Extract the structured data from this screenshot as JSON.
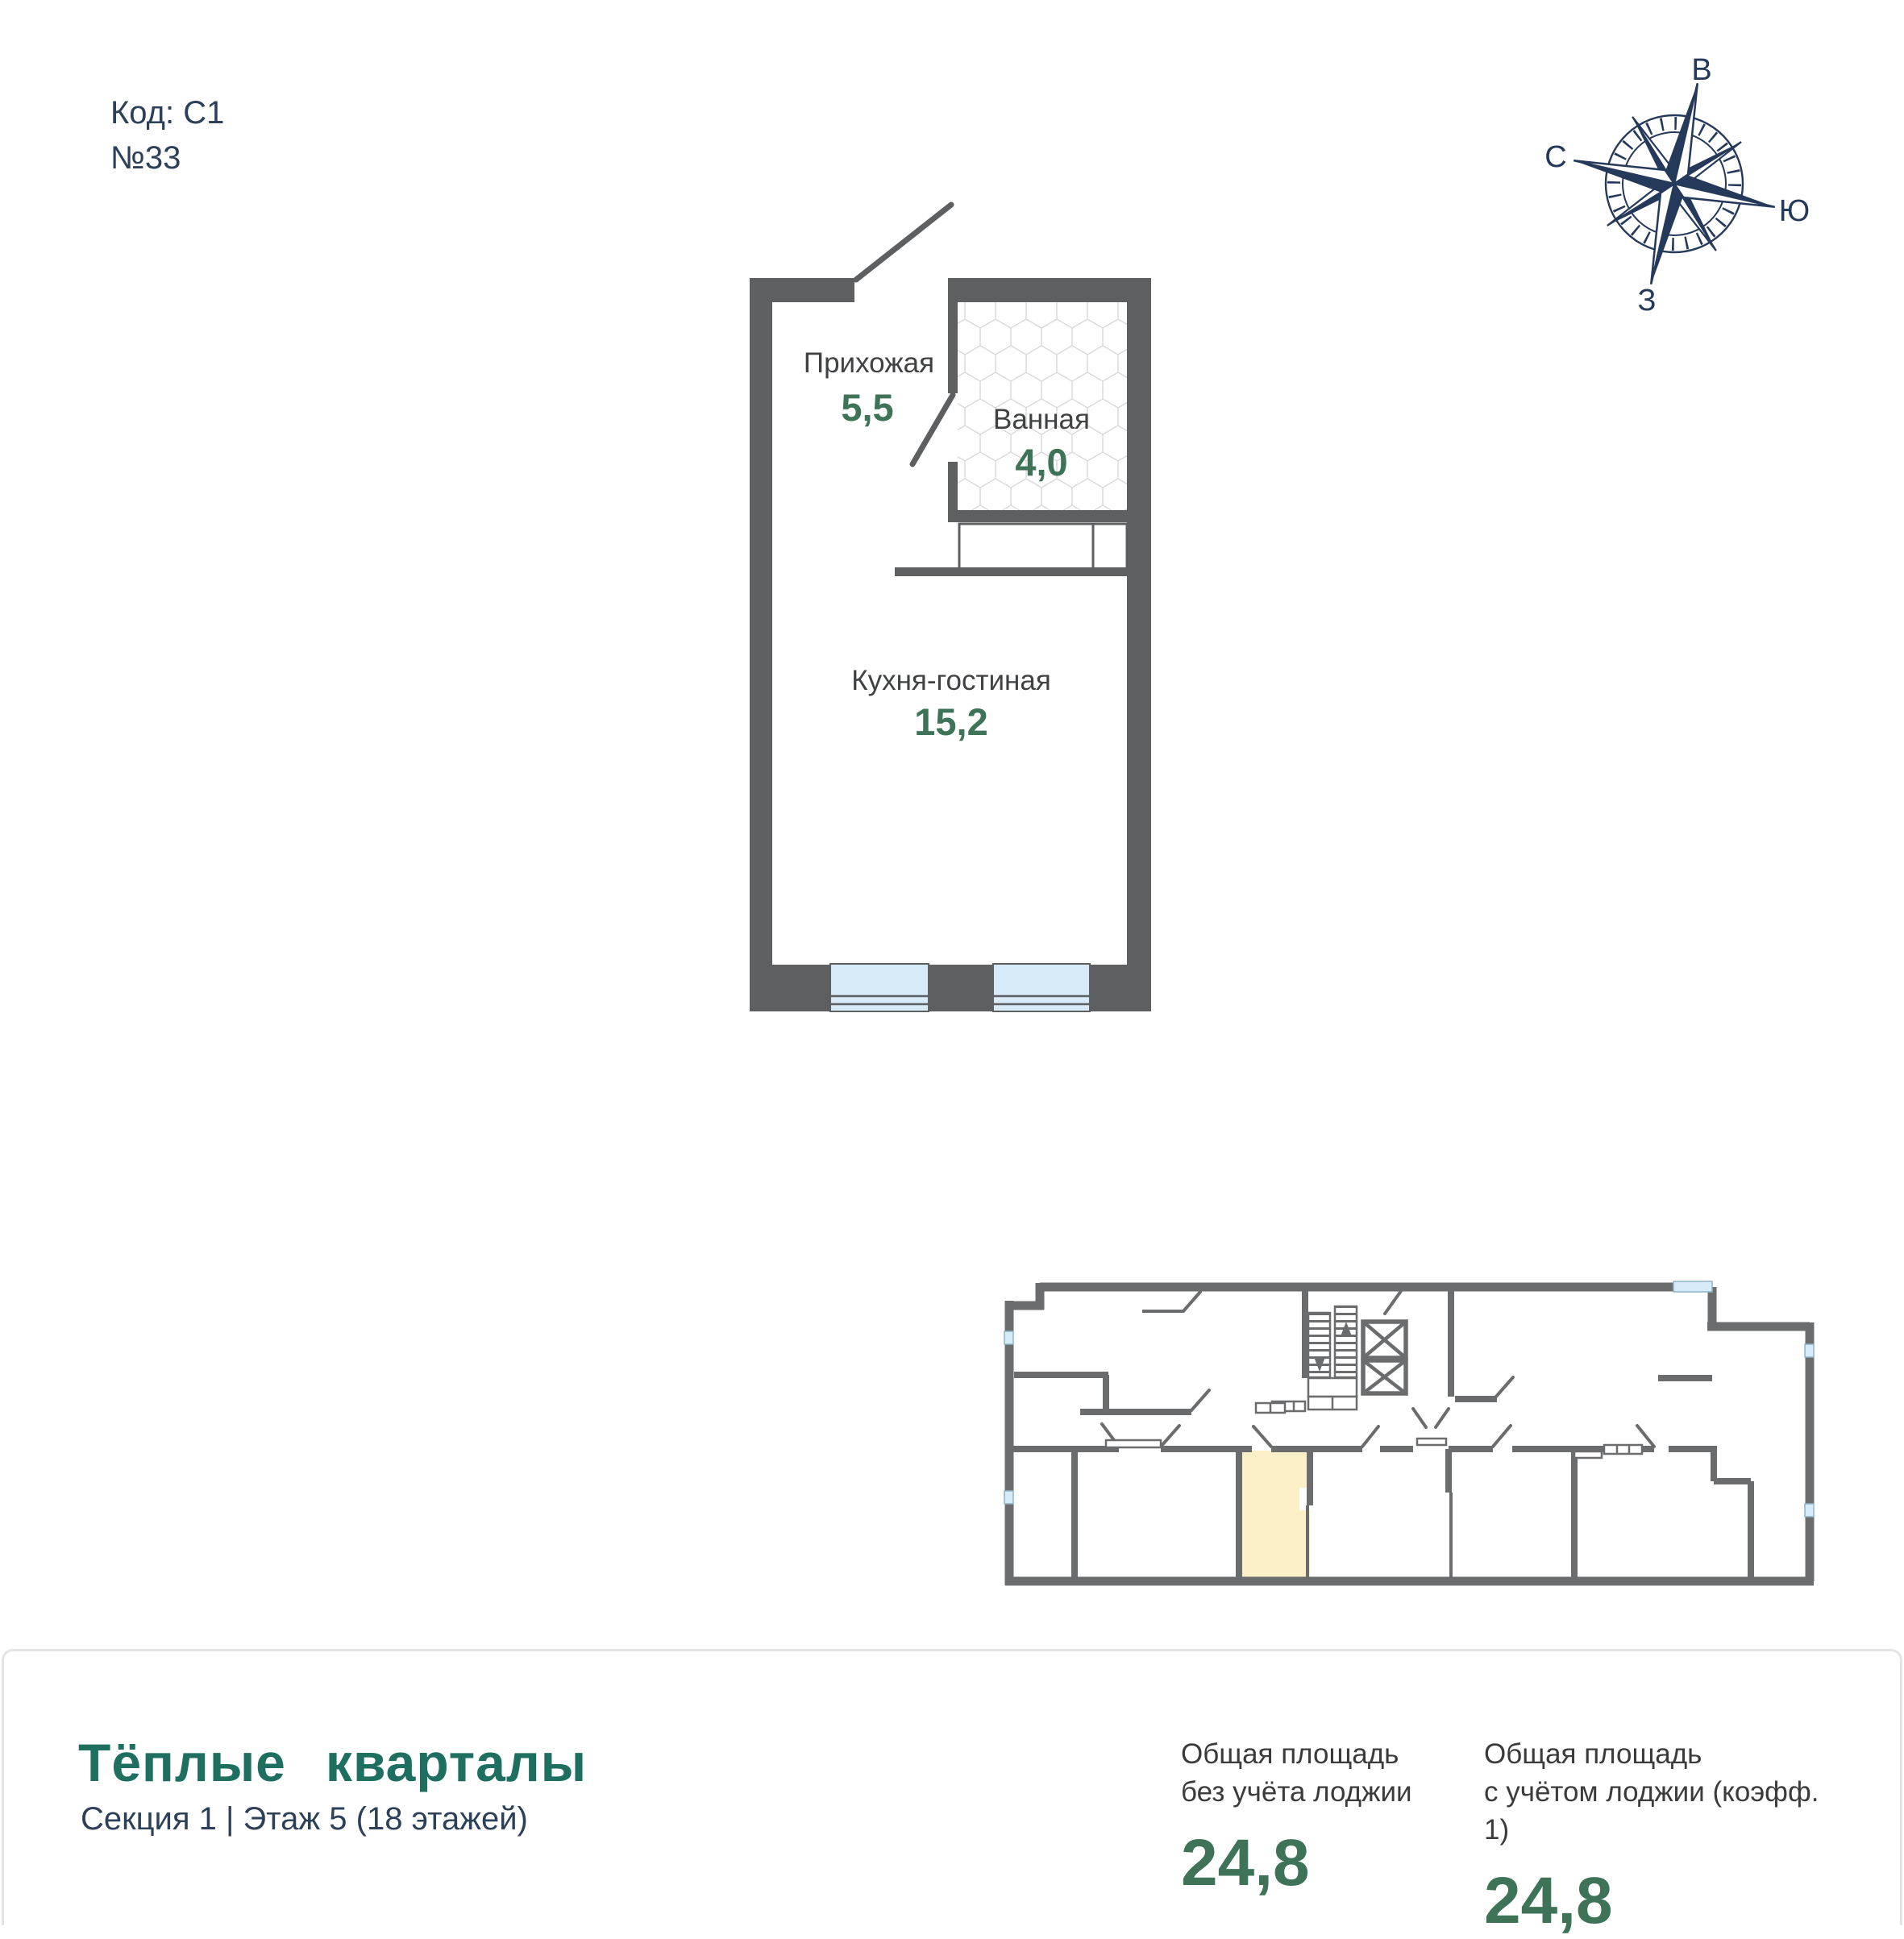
{
  "header": {
    "code": "Код: С1",
    "unit": "№33"
  },
  "compass": {
    "east": "В",
    "north": "С",
    "south": "Ю",
    "west": "З"
  },
  "plan": {
    "rooms": {
      "hallway": {
        "name": "Прихожая",
        "area": "5,5"
      },
      "bathroom": {
        "name": "Ванная",
        "area": "4,0"
      },
      "kitchen": {
        "name": "Кухня-гостиная",
        "area": "15,2"
      }
    }
  },
  "footer": {
    "brand": "Тёплые кварталы",
    "subtitle": "Секция 1 | Этаж 5 (18 этажей)",
    "stats": [
      {
        "label1": "Общая площадь",
        "label2": "без учёта лоджии",
        "value": "24,8"
      },
      {
        "label1": "Общая площадь",
        "label2": "с учётом лоджии (коэфф. 1)",
        "value": "24,8"
      }
    ]
  },
  "colors": {
    "accent_green": "#3e7358",
    "brand_teal": "#1e6f60",
    "navy": "#2c4159",
    "wall_gray": "#5d5f61",
    "highlight_yellow": "#fbf0c8",
    "window_blue": "#d7eaf8"
  }
}
